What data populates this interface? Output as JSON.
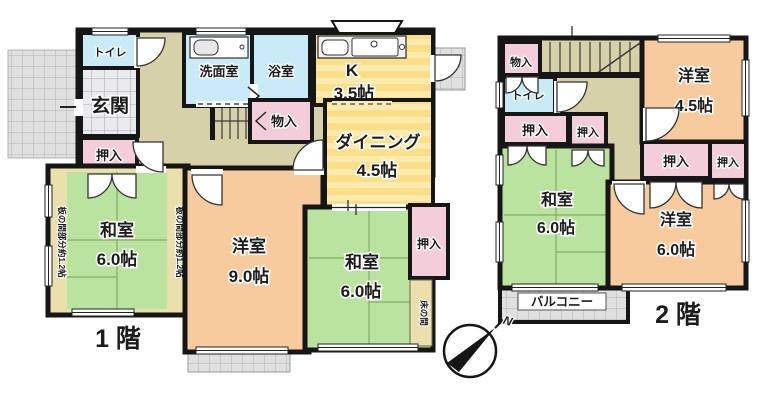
{
  "floor1": {
    "label_floor": "1 階",
    "genkan": "玄関",
    "toilet": "トイレ",
    "washroom": "洗面室",
    "bath": "浴室",
    "kitchen_name": "K",
    "kitchen_size": "3.5帖",
    "dining_name": "ダイニング",
    "dining_size": "4.5帖",
    "storage": "物入",
    "closet_left": "押入",
    "washitsu_left_name": "和室",
    "washitsu_left_size": "6.0帖",
    "itanoma": "板の間部分約1.2帖",
    "yoshitsu_name": "洋室",
    "yoshitsu_size": "9.0帖",
    "washitsu_center_name": "和室",
    "washitsu_center_size": "6.0帖",
    "closet_right": "押入",
    "tokonoma": "床の間"
  },
  "floor2": {
    "label_floor": "2 階",
    "storage": "物入",
    "toilet": "トイレ",
    "closet_a": "押入",
    "closet_b": "押入",
    "yoshitsu_small_name": "洋室",
    "yoshitsu_small_size": "4.5帖",
    "closet_c": "押入",
    "closet_d": "押入",
    "washitsu_name": "和室",
    "washitsu_size": "6.0帖",
    "yoshitsu_name": "洋室",
    "yoshitsu_size": "6.0帖",
    "balcony": "バルコニー"
  },
  "compass": {
    "north": "N"
  },
  "colors": {
    "wall": "#161616",
    "tatami": "#b9e39e",
    "tatami_seam": "#83ad67",
    "western": "#f7cb9e",
    "kitchen_yellow": "#fbdf88",
    "kitchen_yellow_light": "#fdeaae",
    "closet_pink": "#f4cdda",
    "wet_blue": "#c9eaf7",
    "hall_tan": "#d6d1a9",
    "wood_strip": "#ebdfab",
    "tile_gray": "#ebebee",
    "hatch_gray": "#e0e0e0"
  }
}
